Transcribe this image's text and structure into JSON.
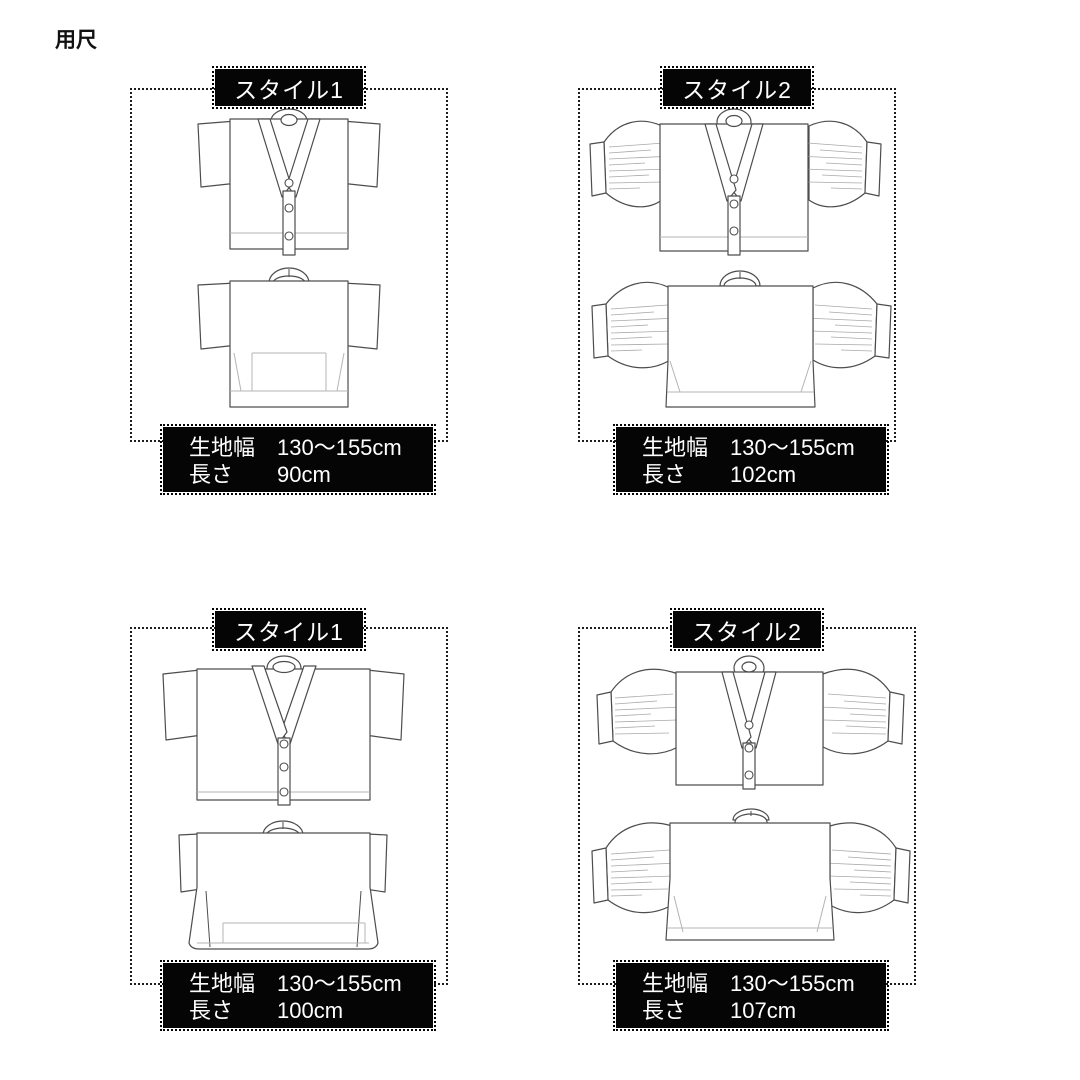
{
  "page_title": "用尺",
  "colors": {
    "background": "#ffffff",
    "box_bg": "#050505",
    "box_text": "#ffffff",
    "dotted_border": "#1c1c1c",
    "drawing_line": "#4d4d4d",
    "drawing_light_line": "#b5b5b5"
  },
  "panels": [
    {
      "label": "スタイル1",
      "rows": [
        {
          "label": "生地幅",
          "value": "130〜155cm"
        },
        {
          "label": "長さ",
          "value": "90cm"
        }
      ]
    },
    {
      "label": "スタイル2",
      "rows": [
        {
          "label": "生地幅",
          "value": "130〜155cm"
        },
        {
          "label": "長さ",
          "value": "102cm"
        }
      ]
    },
    {
      "label": "スタイル1",
      "rows": [
        {
          "label": "生地幅",
          "value": "130〜155cm"
        },
        {
          "label": "長さ",
          "value": "100cm"
        }
      ]
    },
    {
      "label": "スタイル2",
      "rows": [
        {
          "label": "生地幅",
          "value": "130〜155cm"
        },
        {
          "label": "長さ",
          "value": "107cm"
        }
      ]
    }
  ]
}
